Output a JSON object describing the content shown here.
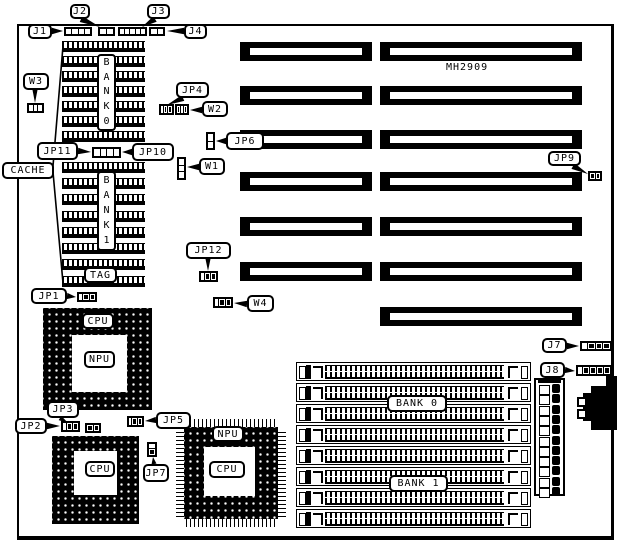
{
  "texts": {
    "model": "MH2909"
  },
  "board": {
    "x": 17,
    "y": 24,
    "w": 597,
    "h": 516
  },
  "model_pos": {
    "x": 446,
    "y": 62
  },
  "labels": [
    {
      "name": "j1",
      "text": "J1",
      "x": 28,
      "y": 24,
      "w": 24,
      "h": 15,
      "leader": {
        "base": [
          52,
          31
        ],
        "apex": [
          63,
          31
        ]
      }
    },
    {
      "name": "j2",
      "text": "J2",
      "x": 70,
      "y": 4,
      "w": 20,
      "h": 15,
      "leader": {
        "base": [
          81,
          19
        ],
        "apex": [
          100,
          27
        ]
      }
    },
    {
      "name": "j3",
      "text": "J3",
      "x": 147,
      "y": 4,
      "w": 23,
      "h": 15,
      "leader": {
        "base": [
          155,
          19
        ],
        "apex": [
          142,
          27
        ]
      }
    },
    {
      "name": "j4",
      "text": "J4",
      "x": 184,
      "y": 24,
      "w": 23,
      "h": 15,
      "leader": {
        "base": [
          184,
          31
        ],
        "apex": [
          167,
          31
        ]
      }
    },
    {
      "name": "w3",
      "text": "W3",
      "x": 23,
      "y": 73,
      "w": 26,
      "h": 17,
      "leader": {
        "base": [
          35,
          90
        ],
        "apex": [
          35,
          103
        ],
        "hw": 2.5
      }
    },
    {
      "name": "jp4",
      "text": "JP4",
      "x": 176,
      "y": 82,
      "w": 33,
      "h": 16,
      "leader": {
        "base": [
          183,
          98
        ],
        "apex": [
          167,
          105
        ]
      }
    },
    {
      "name": "w2",
      "text": "W2",
      "x": 202,
      "y": 101,
      "w": 26,
      "h": 16,
      "leader": {
        "base": [
          202,
          110
        ],
        "apex": [
          190,
          110
        ]
      }
    },
    {
      "name": "jp6",
      "text": "JP6",
      "x": 226,
      "y": 132,
      "w": 38,
      "h": 18,
      "leader": {
        "base": [
          226,
          141
        ],
        "apex": [
          216,
          141
        ]
      }
    },
    {
      "name": "jp11",
      "text": "JP11",
      "x": 37,
      "y": 142,
      "w": 41,
      "h": 18,
      "leader": {
        "base": [
          78,
          151
        ],
        "apex": [
          91,
          152
        ]
      }
    },
    {
      "name": "jp10",
      "text": "JP10",
      "x": 132,
      "y": 143,
      "w": 42,
      "h": 18,
      "leader": {
        "base": [
          132,
          152
        ],
        "apex": [
          122,
          152
        ]
      }
    },
    {
      "name": "cache",
      "text": "CACHE",
      "x": 2,
      "y": 162,
      "w": 52,
      "h": 17
    },
    {
      "name": "w1",
      "text": "W1",
      "x": 199,
      "y": 158,
      "w": 26,
      "h": 17,
      "leader": {
        "base": [
          199,
          167
        ],
        "apex": [
          187,
          167
        ]
      }
    },
    {
      "name": "jp12",
      "text": "JP12",
      "x": 186,
      "y": 242,
      "w": 45,
      "h": 17,
      "leader": {
        "base": [
          208,
          259
        ],
        "apex": [
          208,
          271
        ],
        "hw": 2.5
      }
    },
    {
      "name": "tag",
      "text": "TAG",
      "x": 84,
      "y": 267,
      "w": 33,
      "h": 16
    },
    {
      "name": "jp1",
      "text": "JP1",
      "x": 31,
      "y": 288,
      "w": 36,
      "h": 16,
      "leader": {
        "base": [
          67,
          296
        ],
        "apex": [
          76,
          297
        ]
      }
    },
    {
      "name": "w4",
      "text": "W4",
      "x": 247,
      "y": 295,
      "w": 27,
      "h": 17,
      "leader": {
        "base": [
          247,
          304
        ],
        "apex": [
          234,
          303
        ]
      }
    },
    {
      "name": "cpu-socket1",
      "text": "CPU",
      "x": 82,
      "y": 313,
      "w": 32,
      "h": 16
    },
    {
      "name": "npu-socket1",
      "text": "NPU",
      "x": 84,
      "y": 351,
      "w": 31,
      "h": 17
    },
    {
      "name": "jp3",
      "text": "JP3",
      "x": 47,
      "y": 401,
      "w": 32,
      "h": 17,
      "leader": {
        "base": [
          60,
          418
        ],
        "apex": [
          68,
          423
        ],
        "hw": 2.5
      }
    },
    {
      "name": "jp2",
      "text": "JP2",
      "x": 15,
      "y": 418,
      "w": 32,
      "h": 16,
      "leader": {
        "base": [
          47,
          426
        ],
        "apex": [
          60,
          426
        ]
      }
    },
    {
      "name": "jp5",
      "text": "JP5",
      "x": 156,
      "y": 412,
      "w": 35,
      "h": 17,
      "leader": {
        "base": [
          156,
          420
        ],
        "apex": [
          145,
          421
        ]
      }
    },
    {
      "name": "jp7",
      "text": "JP7",
      "x": 143,
      "y": 464,
      "w": 26,
      "h": 18,
      "leader": {
        "base": [
          154,
          464
        ],
        "apex": [
          153,
          457
        ],
        "hw": 2.5
      }
    },
    {
      "name": "npu-qfp",
      "text": "NPU",
      "x": 212,
      "y": 426,
      "w": 32,
      "h": 16
    },
    {
      "name": "cpu-qfp",
      "text": "CPU",
      "x": 209,
      "y": 461,
      "w": 36,
      "h": 17
    },
    {
      "name": "cpu-socket2",
      "text": "CPU",
      "x": 85,
      "y": 461,
      "w": 30,
      "h": 16
    },
    {
      "name": "j7",
      "text": "J7",
      "x": 542,
      "y": 338,
      "w": 25,
      "h": 15,
      "leader": {
        "base": [
          567,
          346
        ],
        "apex": [
          579,
          346
        ]
      }
    },
    {
      "name": "j8",
      "text": "J8",
      "x": 540,
      "y": 362,
      "w": 25,
      "h": 16,
      "leader": {
        "base": [
          565,
          370
        ],
        "apex": [
          575,
          371
        ]
      }
    },
    {
      "name": "jp9",
      "text": "JP9",
      "x": 548,
      "y": 151,
      "w": 33,
      "h": 15,
      "leader": {
        "base": [
          573,
          166
        ],
        "apex": [
          588,
          174
        ]
      }
    },
    {
      "name": "bank0-simm",
      "text": "BANK 0",
      "x": 387,
      "y": 395,
      "w": 60,
      "h": 17
    },
    {
      "name": "bank1-simm",
      "text": "BANK 1",
      "x": 389,
      "y": 475,
      "w": 59,
      "h": 17
    }
  ],
  "vertical_labels": [
    {
      "name": "bank0-dip",
      "text": "BANK0",
      "x": 97,
      "y": 54,
      "w": 19,
      "h": 77
    },
    {
      "name": "bank1-dip",
      "text": "BANK1",
      "x": 97,
      "y": 171,
      "w": 19,
      "h": 80
    }
  ],
  "jumpers": [
    {
      "name": "j1-conn",
      "x": 64,
      "y": 27,
      "w": 28,
      "h": 9,
      "o": "h",
      "cells": "wwww"
    },
    {
      "name": "j2-conn",
      "x": 98,
      "y": 27,
      "w": 17,
      "h": 9,
      "o": "h",
      "cells": "ww"
    },
    {
      "name": "j3-conn",
      "x": 118,
      "y": 27,
      "w": 29,
      "h": 9,
      "o": "h",
      "cells": "wwwww"
    },
    {
      "name": "j4-conn",
      "x": 149,
      "y": 27,
      "w": 16,
      "h": 9,
      "o": "h",
      "cells": "ww"
    },
    {
      "name": "w3-jumper",
      "x": 27,
      "y": 103,
      "w": 17,
      "h": 10,
      "o": "h",
      "cells": "www"
    },
    {
      "name": "jp4-jumper",
      "x": 159,
      "y": 104,
      "w": 15,
      "h": 11,
      "o": "h",
      "cells": "wbb"
    },
    {
      "name": "w2-jumper",
      "x": 175,
      "y": 104,
      "w": 14,
      "h": 11,
      "o": "h",
      "cells": "bbb"
    },
    {
      "name": "jp6-jumper",
      "x": 206,
      "y": 132,
      "w": 9,
      "h": 18,
      "o": "v",
      "cells": "ww"
    },
    {
      "name": "jp1110-jumper",
      "x": 92,
      "y": 147,
      "w": 29,
      "h": 11,
      "o": "h",
      "cells": "wwww"
    },
    {
      "name": "w1-jumper",
      "x": 177,
      "y": 157,
      "w": 9,
      "h": 23,
      "o": "v",
      "cells": "www"
    },
    {
      "name": "jp12-jumper",
      "x": 199,
      "y": 271,
      "w": 19,
      "h": 11,
      "o": "h",
      "cells": "wbb"
    },
    {
      "name": "jp1-jumper",
      "x": 77,
      "y": 292,
      "w": 20,
      "h": 10,
      "o": "h",
      "cells": "wbb"
    },
    {
      "name": "w4-jumper",
      "x": 213,
      "y": 297,
      "w": 20,
      "h": 11,
      "o": "h",
      "cells": "wbb"
    },
    {
      "name": "jp2-jumper",
      "x": 61,
      "y": 421,
      "w": 19,
      "h": 11,
      "o": "h",
      "cells": "wbb"
    },
    {
      "name": "jp3-jumper",
      "x": 85,
      "y": 423,
      "w": 16,
      "h": 10,
      "o": "h",
      "cells": "bb"
    },
    {
      "name": "jp5-jumper",
      "x": 127,
      "y": 416,
      "w": 17,
      "h": 11,
      "o": "h",
      "cells": "wbb"
    },
    {
      "name": "jp7-jumper",
      "x": 147,
      "y": 442,
      "w": 10,
      "h": 15,
      "o": "v",
      "cells": "wb"
    },
    {
      "name": "j7-jumper",
      "x": 580,
      "y": 341,
      "w": 32,
      "h": 10,
      "o": "h",
      "cells": "wbbb"
    },
    {
      "name": "j8-jumper",
      "x": 576,
      "y": 365,
      "w": 36,
      "h": 11,
      "o": "h",
      "cells": "wbbbb"
    },
    {
      "name": "jp9-jumper",
      "x": 588,
      "y": 171,
      "w": 14,
      "h": 10,
      "o": "h",
      "cells": "bb"
    }
  ],
  "isa_slots": {
    "left": {
      "x": 240,
      "w": 132,
      "h": 19,
      "ys": [
        42,
        86,
        130,
        172,
        217,
        262
      ]
    },
    "right": {
      "x": 380,
      "w": 202,
      "h": 19,
      "ys": [
        42,
        86,
        130,
        172,
        217,
        262,
        307
      ]
    }
  },
  "dip_blocks": [
    {
      "name": "cache-bank0",
      "x": 62,
      "w": 83,
      "h": 11,
      "ys": [
        41,
        56,
        71,
        86,
        101,
        116,
        131
      ]
    },
    {
      "name": "cache-bank1",
      "x": 62,
      "w": 83,
      "h": 11,
      "ys": [
        162,
        178,
        194,
        211,
        227,
        243,
        259,
        276
      ]
    }
  ],
  "sockets": {
    "pga1": {
      "outer": [
        43,
        308,
        109,
        102
      ],
      "center": [
        72,
        335,
        55,
        57
      ],
      "sub": [
        77,
        339,
        46,
        50
      ],
      "subcenter": [
        85,
        348,
        30,
        33
      ]
    },
    "pga2": {
      "outer": [
        52,
        436,
        87,
        88
      ],
      "center": [
        74,
        451,
        43,
        44
      ]
    },
    "qfp": {
      "body": [
        184,
        427,
        94,
        92
      ],
      "center": [
        204,
        447,
        51,
        49
      ],
      "leads_top": [
        186,
        419,
        90,
        8
      ],
      "leads_bottom": [
        186,
        519,
        90,
        8
      ],
      "leads_left": [
        176,
        429,
        8,
        88
      ],
      "leads_right": [
        278,
        429,
        8,
        88
      ]
    }
  },
  "simm": {
    "x": 296,
    "w": 235,
    "h": 19,
    "y0": 362,
    "pitch": 21,
    "count": 8
  },
  "power_connector": {
    "x": 534,
    "y": 378,
    "w": 31,
    "h": 118,
    "cells": 11,
    "pitch": 10.3
  },
  "keyboard_connector": {
    "step": [
      606,
      376,
      11,
      10
    ],
    "main": [
      591,
      386,
      26,
      44
    ],
    "bulge": [
      583,
      393,
      10,
      28
    ],
    "notches": [
      [
        577,
        397,
        10,
        10
      ],
      [
        577,
        409,
        10,
        10
      ]
    ]
  },
  "cache_bracket": "63,46 53,166 53,172 63,283"
}
